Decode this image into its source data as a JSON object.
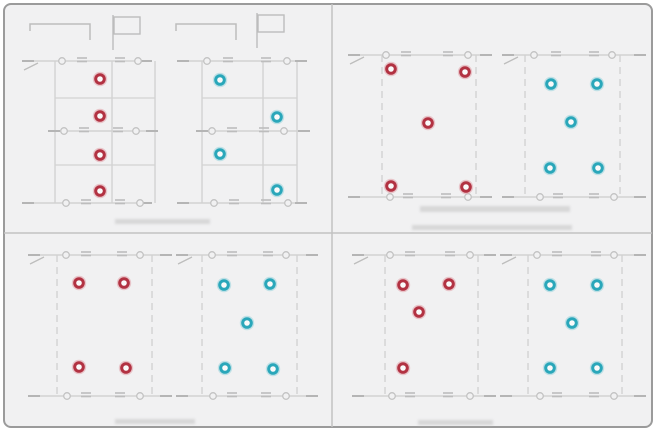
{
  "canvas": {
    "width": 671,
    "height": 433,
    "background": "#ffffff"
  },
  "frame": {
    "x": 3,
    "y": 3,
    "width": 650,
    "height": 425,
    "radius": 7,
    "fill": "#f1f1f2",
    "stroke": "#9b9b9b",
    "stroke_width": 2
  },
  "dividers": {
    "vertical_x": 332,
    "horizontal_y": 233,
    "color": "#c2c2c2",
    "width": 1.5
  },
  "style": {
    "line": "#d2d2d2",
    "line_dark": "#bdbdbd",
    "lead": "#b5b5b5",
    "symbol_circle_stroke": "#c3c3c3",
    "smudge": "#c6c6c6",
    "marker_hole": "#fafafa",
    "marker_colors": {
      "red": {
        "ring": "#b23242",
        "halo": "#e2a7ae"
      },
      "cyan": {
        "ring": "#2aa7ba",
        "halo": "#9fd6dd"
      }
    }
  },
  "quadrants": [
    {
      "name": "top-left",
      "brackets": [
        {
          "x0": 30,
          "y0": 24,
          "x1": 90,
          "tail": 16,
          "tick": 7
        },
        {
          "x0": 176,
          "y0": 24,
          "x1": 236,
          "tail": 16,
          "tick": 7
        }
      ],
      "flags": [
        {
          "x": 114,
          "y": 17,
          "w": 26,
          "h": 17,
          "pole_bottom": 50
        },
        {
          "x": 258,
          "y": 15,
          "w": 26,
          "h": 17,
          "pole_bottom": 48
        }
      ],
      "buses": [
        {
          "y": 61,
          "x0": 22,
          "x1": 152,
          "circles": [
            62,
            138
          ],
          "hatches": [
            82,
            120
          ],
          "slash": true
        },
        {
          "y": 131,
          "x0": 48,
          "x1": 158,
          "circles": [
            64,
            136
          ],
          "hatches": [
            84,
            118
          ],
          "slash": false
        },
        {
          "y": 203,
          "x0": 22,
          "x1": 152,
          "circles": [
            66,
            140
          ],
          "hatches": [
            86,
            120
          ],
          "slash": false
        },
        {
          "y": 61,
          "x0": 177,
          "x1": 307,
          "circles": [
            207,
            287
          ],
          "hatches": [
            228,
            266
          ],
          "slash": false
        },
        {
          "y": 131,
          "x0": 196,
          "x1": 310,
          "circles": [
            212,
            284
          ],
          "hatches": [
            232,
            264
          ],
          "slash": false
        },
        {
          "y": 203,
          "x0": 177,
          "x1": 307,
          "circles": [
            214,
            288
          ],
          "hatches": [
            234,
            266
          ],
          "slash": false
        }
      ],
      "rails": [
        {
          "x": 55,
          "y0": 61,
          "y1": 203,
          "dashed": false
        },
        {
          "x": 112,
          "y0": 61,
          "y1": 203,
          "dashed": false
        },
        {
          "x": 155,
          "y0": 61,
          "y1": 203,
          "dashed": false
        },
        {
          "x": 202,
          "y0": 61,
          "y1": 203,
          "dashed": false
        },
        {
          "x": 263,
          "y0": 61,
          "y1": 203,
          "dashed": false
        },
        {
          "x": 297,
          "y0": 61,
          "y1": 203,
          "dashed": false
        }
      ],
      "rungs": [
        {
          "y": 98,
          "x0": 55,
          "x1": 155
        },
        {
          "y": 165,
          "x0": 55,
          "x1": 155
        },
        {
          "y": 98,
          "x0": 202,
          "x1": 297
        },
        {
          "y": 165,
          "x0": 202,
          "x1": 297
        }
      ],
      "smudges": [
        {
          "x": 115,
          "y": 219,
          "w": 95,
          "h": 5
        }
      ],
      "markers": [
        {
          "x": 100,
          "y": 79,
          "color": "red"
        },
        {
          "x": 100,
          "y": 116,
          "color": "red"
        },
        {
          "x": 100,
          "y": 155,
          "color": "red"
        },
        {
          "x": 100,
          "y": 191,
          "color": "red"
        },
        {
          "x": 220,
          "y": 80,
          "color": "cyan"
        },
        {
          "x": 277,
          "y": 117,
          "color": "cyan"
        },
        {
          "x": 220,
          "y": 154,
          "color": "cyan"
        },
        {
          "x": 277,
          "y": 190,
          "color": "cyan"
        }
      ]
    },
    {
      "name": "top-right",
      "brackets": [],
      "flags": [],
      "rungs": [],
      "buses": [
        {
          "y": 55,
          "x0": 348,
          "x1": 492,
          "circles": [
            386,
            468
          ],
          "hatches": [
            406,
            448
          ],
          "slash": true
        },
        {
          "y": 197,
          "x0": 348,
          "x1": 492,
          "circles": [
            390,
            468
          ],
          "hatches": [
            408,
            446
          ],
          "slash": false
        },
        {
          "y": 55,
          "x0": 502,
          "x1": 646,
          "circles": [
            534,
            612
          ],
          "hatches": [
            556,
            594
          ],
          "slash": true
        },
        {
          "y": 197,
          "x0": 502,
          "x1": 646,
          "circles": [
            540,
            614
          ],
          "hatches": [
            558,
            594
          ],
          "slash": false
        }
      ],
      "rails": [
        {
          "x": 382,
          "y0": 55,
          "y1": 197,
          "dashed": true
        },
        {
          "x": 476,
          "y0": 55,
          "y1": 197,
          "dashed": true
        },
        {
          "x": 525,
          "y0": 55,
          "y1": 197,
          "dashed": true
        },
        {
          "x": 620,
          "y0": 55,
          "y1": 197,
          "dashed": true
        }
      ],
      "smudges": [
        {
          "x": 420,
          "y": 206,
          "w": 150,
          "h": 6
        },
        {
          "x": 412,
          "y": 225,
          "w": 160,
          "h": 5
        }
      ],
      "markers": [
        {
          "x": 391,
          "y": 69,
          "color": "red"
        },
        {
          "x": 465,
          "y": 72,
          "color": "red"
        },
        {
          "x": 428,
          "y": 123,
          "color": "red"
        },
        {
          "x": 391,
          "y": 186,
          "color": "red"
        },
        {
          "x": 466,
          "y": 187,
          "color": "red"
        },
        {
          "x": 551,
          "y": 84,
          "color": "cyan"
        },
        {
          "x": 597,
          "y": 84,
          "color": "cyan"
        },
        {
          "x": 571,
          "y": 122,
          "color": "cyan"
        },
        {
          "x": 550,
          "y": 168,
          "color": "cyan"
        },
        {
          "x": 598,
          "y": 168,
          "color": "cyan"
        }
      ]
    },
    {
      "name": "bottom-left",
      "brackets": [],
      "flags": [],
      "rungs": [],
      "buses": [
        {
          "y": 255,
          "x0": 28,
          "x1": 172,
          "circles": [
            66,
            140
          ],
          "hatches": [
            86,
            122
          ],
          "slash": true
        },
        {
          "y": 396,
          "x0": 28,
          "x1": 172,
          "circles": [
            67,
            140
          ],
          "hatches": [
            86,
            120
          ],
          "slash": false
        },
        {
          "y": 255,
          "x0": 176,
          "x1": 318,
          "circles": [
            212,
            286
          ],
          "hatches": [
            232,
            268
          ],
          "slash": true
        },
        {
          "y": 396,
          "x0": 176,
          "x1": 318,
          "circles": [
            213,
            286
          ],
          "hatches": [
            232,
            266
          ],
          "slash": false
        }
      ],
      "rails": [
        {
          "x": 57,
          "y0": 255,
          "y1": 396,
          "dashed": true
        },
        {
          "x": 152,
          "y0": 255,
          "y1": 396,
          "dashed": true
        },
        {
          "x": 202,
          "y0": 255,
          "y1": 396,
          "dashed": true
        },
        {
          "x": 297,
          "y0": 255,
          "y1": 396,
          "dashed": true
        }
      ],
      "smudges": [
        {
          "x": 115,
          "y": 419,
          "w": 80,
          "h": 5
        }
      ],
      "markers": [
        {
          "x": 79,
          "y": 283,
          "color": "red"
        },
        {
          "x": 124,
          "y": 283,
          "color": "red"
        },
        {
          "x": 79,
          "y": 367,
          "color": "red"
        },
        {
          "x": 126,
          "y": 368,
          "color": "red"
        },
        {
          "x": 224,
          "y": 285,
          "color": "cyan"
        },
        {
          "x": 270,
          "y": 284,
          "color": "cyan"
        },
        {
          "x": 247,
          "y": 323,
          "color": "cyan"
        },
        {
          "x": 225,
          "y": 368,
          "color": "cyan"
        },
        {
          "x": 273,
          "y": 369,
          "color": "cyan"
        }
      ]
    },
    {
      "name": "bottom-right",
      "brackets": [],
      "flags": [],
      "rungs": [],
      "buses": [
        {
          "y": 255,
          "x0": 352,
          "x1": 496,
          "circles": [
            390,
            470
          ],
          "hatches": [
            410,
            450
          ],
          "slash": true
        },
        {
          "y": 396,
          "x0": 352,
          "x1": 496,
          "circles": [
            392,
            470
          ],
          "hatches": [
            410,
            448
          ],
          "slash": false
        },
        {
          "y": 255,
          "x0": 500,
          "x1": 646,
          "circles": [
            537,
            614
          ],
          "hatches": [
            557,
            596
          ],
          "slash": true
        },
        {
          "y": 396,
          "x0": 500,
          "x1": 646,
          "circles": [
            540,
            614
          ],
          "hatches": [
            557,
            594
          ],
          "slash": false
        }
      ],
      "rails": [
        {
          "x": 385,
          "y0": 255,
          "y1": 396,
          "dashed": true
        },
        {
          "x": 478,
          "y0": 255,
          "y1": 396,
          "dashed": true
        },
        {
          "x": 528,
          "y0": 255,
          "y1": 396,
          "dashed": true
        },
        {
          "x": 622,
          "y0": 255,
          "y1": 396,
          "dashed": true
        }
      ],
      "smudges": [
        {
          "x": 418,
          "y": 420,
          "w": 75,
          "h": 5
        }
      ],
      "markers": [
        {
          "x": 403,
          "y": 285,
          "color": "red"
        },
        {
          "x": 449,
          "y": 284,
          "color": "red"
        },
        {
          "x": 419,
          "y": 312,
          "color": "red"
        },
        {
          "x": 403,
          "y": 368,
          "color": "red"
        },
        {
          "x": 550,
          "y": 285,
          "color": "cyan"
        },
        {
          "x": 597,
          "y": 285,
          "color": "cyan"
        },
        {
          "x": 572,
          "y": 323,
          "color": "cyan"
        },
        {
          "x": 550,
          "y": 368,
          "color": "cyan"
        },
        {
          "x": 597,
          "y": 368,
          "color": "cyan"
        }
      ]
    }
  ]
}
